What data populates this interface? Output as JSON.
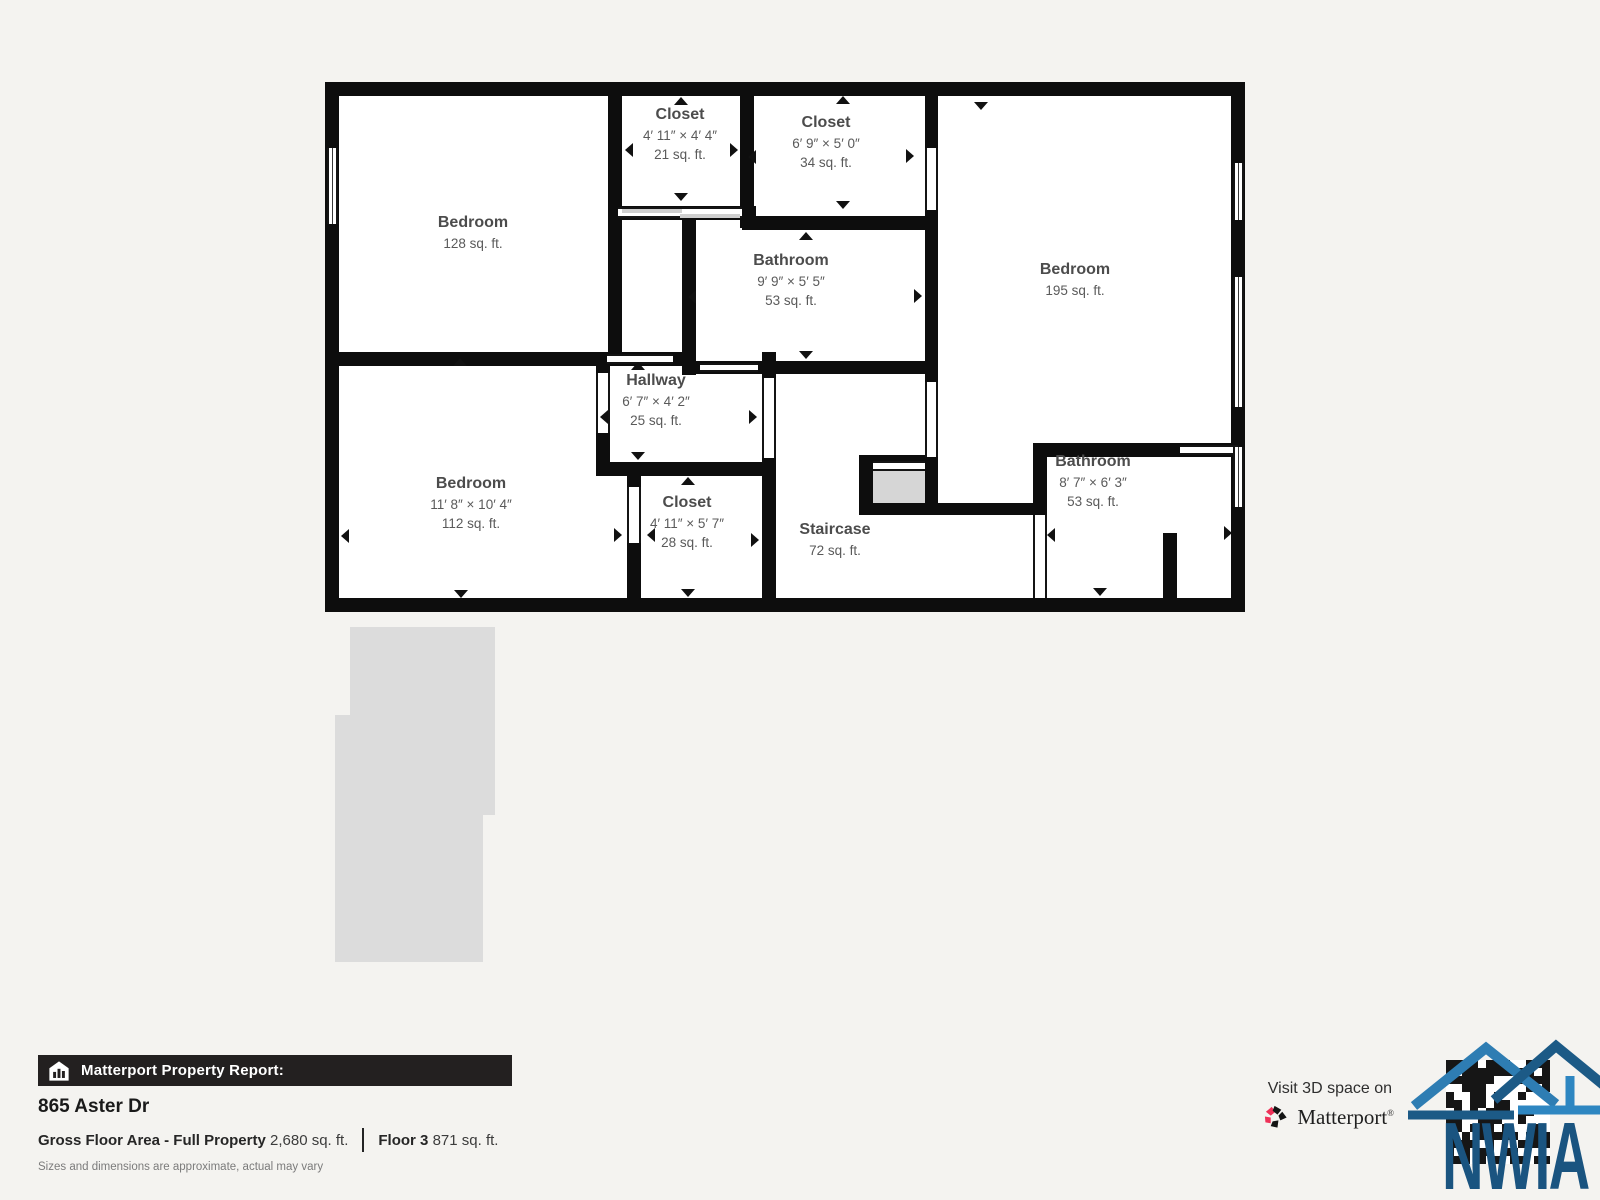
{
  "floorplan": {
    "rooms": [
      {
        "name": "Bedroom",
        "dims": "",
        "area": "128 sq. ft."
      },
      {
        "name": "Closet",
        "dims": "4′ 11″ × 4′ 4″",
        "area": "21 sq. ft."
      },
      {
        "name": "Closet",
        "dims": "6′ 9″ × 5′ 0″",
        "area": "34 sq. ft."
      },
      {
        "name": "Bathroom",
        "dims": "9′ 9″ × 5′ 5″",
        "area": "53 sq. ft."
      },
      {
        "name": "Bedroom",
        "dims": "",
        "area": "195 sq. ft."
      },
      {
        "name": "Hallway",
        "dims": "6′ 7″ × 4′ 2″",
        "area": "25 sq. ft."
      },
      {
        "name": "Bedroom",
        "dims": "11′ 8″ × 10′ 4″",
        "area": "112 sq. ft."
      },
      {
        "name": "Closet",
        "dims": "4′ 11″ × 5′ 7″",
        "area": "28 sq. ft."
      },
      {
        "name": "Staircase",
        "dims": "",
        "area": "72 sq. ft."
      },
      {
        "name": "Bathroom",
        "dims": "8′ 7″ × 6′ 3″",
        "area": "53 sq. ft."
      }
    ]
  },
  "report": {
    "banner": "Matterport Property Report:",
    "address": "865 Aster Dr",
    "gross_label": "Gross Floor Area - Full Property",
    "gross_value": "2,680 sq. ft.",
    "floor_label": "Floor 3",
    "floor_value": "871 sq. ft.",
    "disclaimer": "Sizes and dimensions are approximate, actual may vary"
  },
  "cta": {
    "line": "Visit 3D space on",
    "brand": "Matterport",
    "mark": "®"
  },
  "watermark": {
    "text": "NWIA"
  },
  "colors": {
    "wall": "#0d0d0d",
    "background": "#f4f3f0",
    "silhouette": "#dcdcdc",
    "matterport_pink": "#ee3158",
    "nwia_blue_dark": "#1c5a86",
    "nwia_blue_light": "#2e86c1"
  }
}
